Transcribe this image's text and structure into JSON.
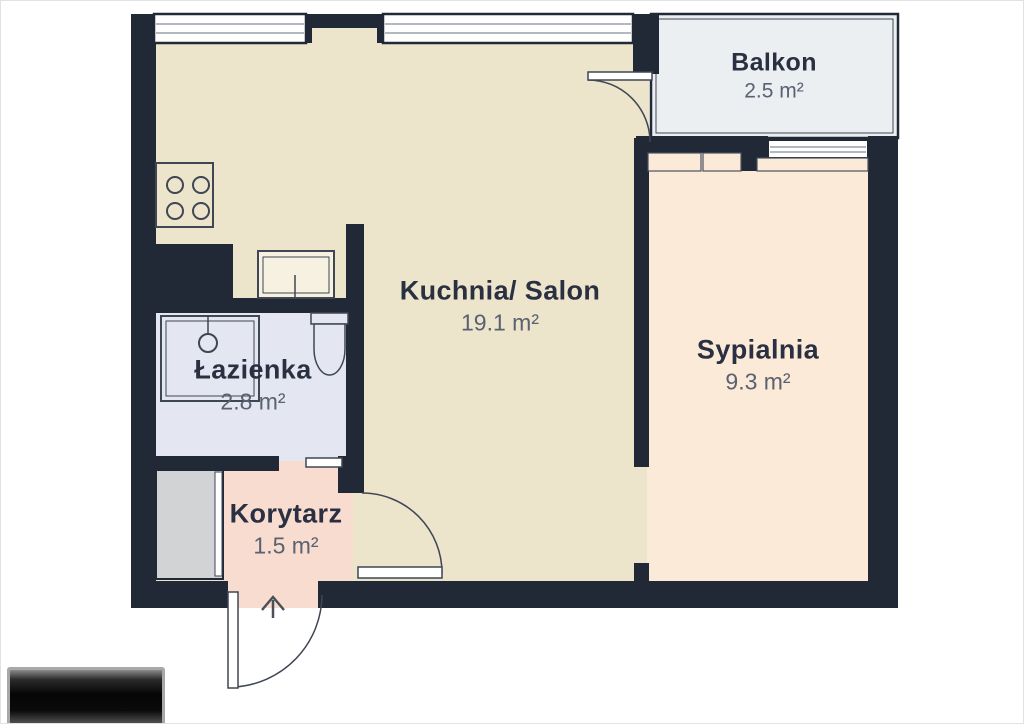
{
  "plan": {
    "type": "apartment-floor-plan",
    "rooms": [
      {
        "name": "Kuchnia/ Salon",
        "area": "19.1 m²",
        "area_m2": 19.1,
        "color": "#ece4cb"
      },
      {
        "name": "Sypialnia",
        "area": "9.3 m²",
        "area_m2": 9.3,
        "color": "#fcead9"
      },
      {
        "name": "Balkon",
        "area": "2.5 m²",
        "area_m2": 2.5,
        "color": "#eceff2"
      },
      {
        "name": "Łazienka",
        "area": "2.8 m²",
        "area_m2": 2.8,
        "color": "#e4e7f1"
      },
      {
        "name": "Korytarz",
        "area": "1.5 m²",
        "area_m2": 1.5,
        "color": "#f7dccf"
      }
    ],
    "colors": {
      "wall": "#212836",
      "room_name_text": "#2a3041",
      "area_text": "#5a6170",
      "window_fill": "#ffffff",
      "wardrobe": "#d2d3d5",
      "thin_outline": "#3f4654"
    },
    "fixtures": [
      "stove-4-burner",
      "kitchen-sink",
      "shower",
      "toilet",
      "wardrobe"
    ],
    "doors": [
      "entrance-door",
      "balcony-door",
      "kitchen-door",
      "bathroom-sliding-door"
    ],
    "windows_count": 3,
    "entrance_arrow_direction": "up",
    "watermark": "redacted-logo"
  }
}
